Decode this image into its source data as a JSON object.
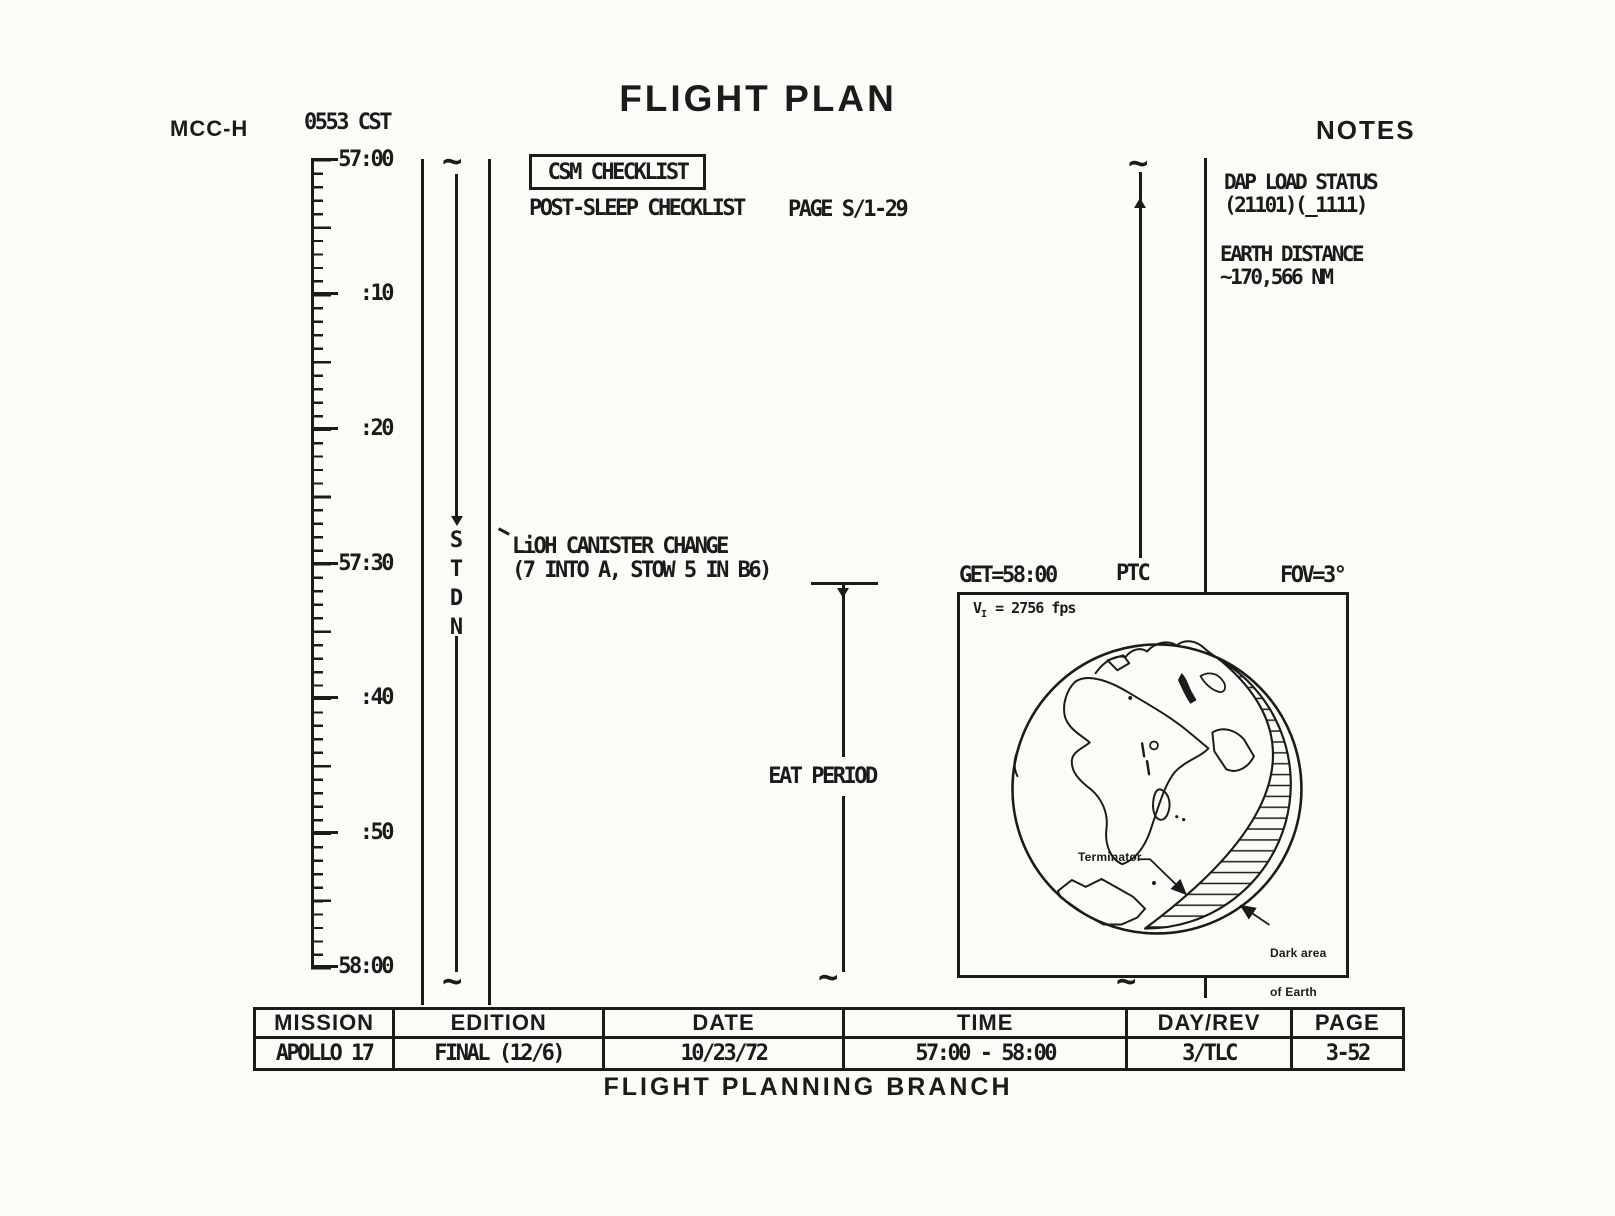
{
  "page": {
    "title": "FLIGHT PLAN",
    "mcc_label": "MCC-H",
    "cst_time": "0553 CST",
    "notes_header": "NOTES",
    "footer": "FLIGHT PLANNING BRANCH"
  },
  "timeline": {
    "labels": [
      "57:00",
      ":10",
      ":20",
      "57:30",
      ":40",
      ":50",
      "58:00"
    ],
    "stdn": "STDN",
    "continuation_mark": "~"
  },
  "activities": {
    "csm_checklist": "CSM CHECKLIST",
    "post_sleep": "POST-SLEEP CHECKLIST",
    "post_sleep_page": "PAGE S/1-29",
    "lioh_line1": "LiOH CANISTER CHANGE",
    "lioh_line2": "(7 INTO A, STOW 5 IN B6)",
    "eat_period": "EAT PERIOD"
  },
  "earth_view": {
    "get_label": "GET=58:00",
    "ptc_label": "PTC",
    "fov_label": "FOV=3°",
    "velocity_label": "V",
    "velocity_sub": "I",
    "velocity_value": " = 2756 fps",
    "terminator_label": "Terminator",
    "dark_area_line1": "Dark area",
    "dark_area_line2": "of Earth"
  },
  "notes": {
    "dap_line1": "DAP LOAD STATUS",
    "dap_line2": "(21101)(_1111)",
    "dist_line1": "EARTH DISTANCE",
    "dist_line2": "~170,566 NM"
  },
  "table": {
    "headers": [
      "MISSION",
      "EDITION",
      "DATE",
      "TIME",
      "DAY/REV",
      "PAGE"
    ],
    "values": [
      "APOLLO 17",
      "FINAL (12/6)",
      "10/23/72",
      "57:00 - 58:00",
      "3/TLC",
      "3-52"
    ]
  },
  "ink_color": "#1b1b1b"
}
